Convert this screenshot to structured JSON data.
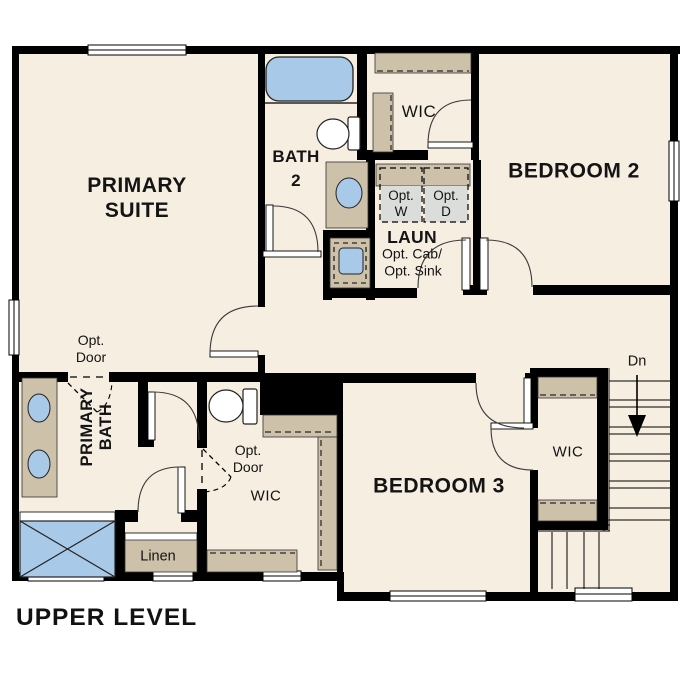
{
  "title": "UPPER LEVEL",
  "colors": {
    "floor": "#f5eee1",
    "wall": "#000000",
    "cabinet_tan": "#cdc1aa",
    "fixture_blue": "#a9c9e9",
    "appliance_gray": "#dbdddb",
    "text": "#141414"
  },
  "rooms": {
    "primary_suite": {
      "line1": "PRIMARY",
      "line2": "SUITE"
    },
    "bath2": {
      "line1": "BATH",
      "line2": "2"
    },
    "wic_top": "WIC",
    "bedroom2": "BEDROOM 2",
    "laundry": {
      "name": "LAUN",
      "opt_cab": "Opt. Cab/",
      "opt_sink": "Opt. Sink",
      "washer": {
        "line1": "Opt.",
        "line2": "W"
      },
      "dryer": {
        "line1": "Opt.",
        "line2": "D"
      }
    },
    "opt_door_suite": {
      "line1": "Opt.",
      "line2": "Door"
    },
    "primary_bath": {
      "line1": "PRIMARY",
      "line2": "BATH"
    },
    "opt_door_wic": {
      "line1": "Opt.",
      "line2": "Door"
    },
    "wic_primary": "WIC",
    "linen": "Linen",
    "bedroom3": "BEDROOM 3",
    "wic_bedroom3": "WIC",
    "stairs_down": "Dn"
  }
}
